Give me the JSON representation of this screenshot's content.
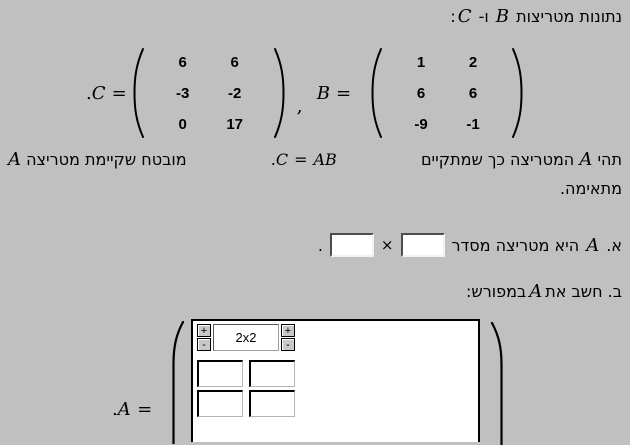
{
  "colors": {
    "background": "#c0c0c0",
    "panel_background": "#ffffff",
    "text": "#000000"
  },
  "title": {
    "pre": "נתונות מטריצות",
    "b": "B",
    "conj": "ו-",
    "c": "C",
    "colon": ":"
  },
  "matrices": {
    "c": {
      "dot": ".",
      "label": "C",
      "eq": "=",
      "rows": [
        [
          "6",
          "6"
        ],
        [
          "-3",
          "-2"
        ],
        [
          "0",
          "17"
        ]
      ]
    },
    "comma": ",",
    "b": {
      "label": "B",
      "eq": "=",
      "rows": [
        [
          "1",
          "2"
        ],
        [
          "6",
          "6"
        ],
        [
          "-9",
          "-1"
        ]
      ]
    }
  },
  "paragraph": {
    "p1": "תהי",
    "a1": "A",
    "p2": "המטריצה כך שמתקיים",
    "formula_c": "C",
    "formula_eq": "=",
    "formula_ab": "AB",
    "dot": ".",
    "p3": "מובטח שקיימת מטריצה",
    "a2": "A",
    "p4": "מתאימה."
  },
  "section_a": {
    "prefix": "א.",
    "a": "A",
    "text": "היא מטריצה מסדר",
    "times": "×",
    "period": ".",
    "rows_value": "",
    "cols_value": ""
  },
  "section_b": {
    "prefix": "ב.",
    "text1": "חשב את",
    "a": "A",
    "text2": "במפורש:"
  },
  "answer": {
    "dot": ".",
    "label": "A",
    "eq": "=",
    "size_display": "2x2",
    "plus_label": "+",
    "minus_label": "-",
    "cells": [
      "",
      "",
      "",
      ""
    ]
  }
}
